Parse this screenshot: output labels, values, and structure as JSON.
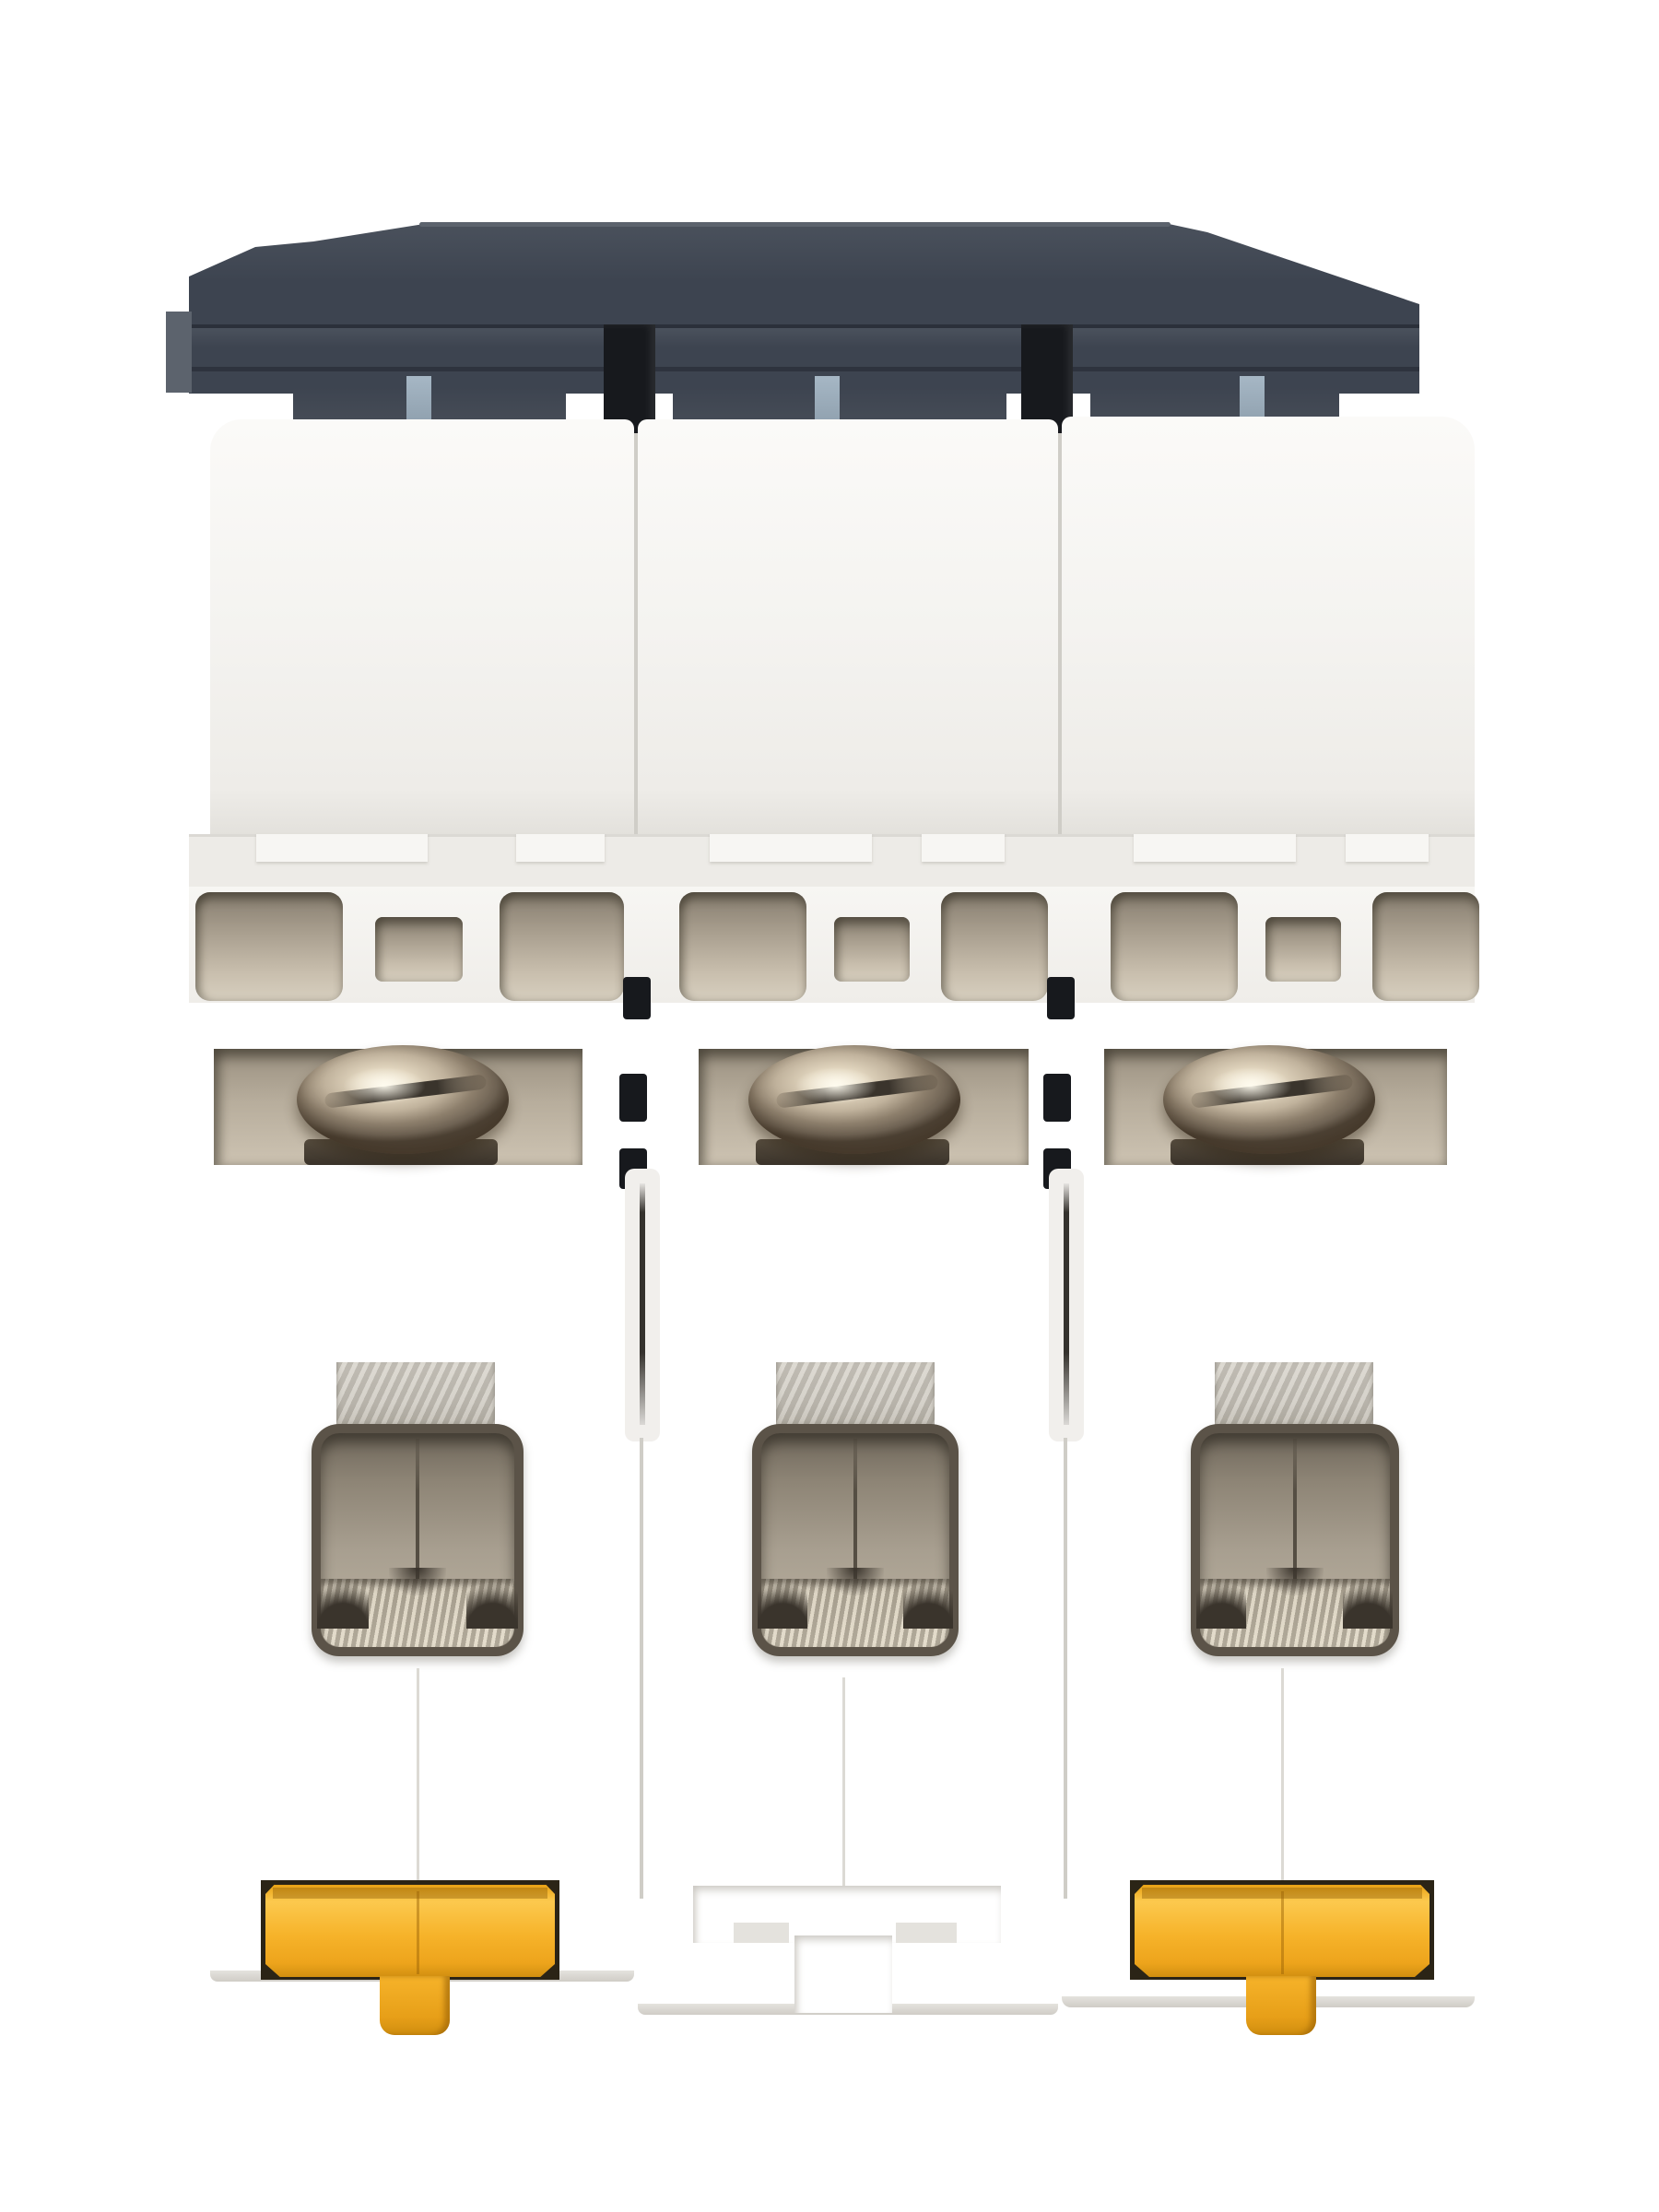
{
  "scene": {
    "kind": "product-photo",
    "subject": "three-pole miniature circuit breaker, rear/bottom view",
    "background": "plain white studio backdrop",
    "visible_text": "",
    "module_count": 3,
    "modules": [
      {
        "id": "pole-1",
        "terminal_screw": true,
        "din_clip": "yellow clip present"
      },
      {
        "id": "pole-2",
        "terminal_screw": true,
        "din_clip": "empty T-shaped slot"
      },
      {
        "id": "pole-3",
        "terminal_screw": true,
        "din_clip": "yellow clip present"
      }
    ],
    "parts": [
      "dark-gray-housing-top",
      "inter-module-black-tab",
      "blue-gray-latch-tab",
      "white-module-body",
      "ventilation-opening",
      "terminal-screw-head",
      "terminal-cage-window",
      "metal-clamp-tab",
      "din-rail-clip",
      "din-clip-release-tab"
    ]
  },
  "colors": {
    "bg": "#ffffff",
    "grayMain": "#3d4450",
    "grayLight": "#4b525d",
    "grayRim": "#5c636d",
    "grayDark": "#2b303a",
    "grayCastle": "#474d57",
    "blackTab": "#17191d",
    "blueTab": "#a6b7c5",
    "white": "#f4f3f0",
    "ledge": "#edebe7",
    "ventDark": "#857c6e",
    "ventLight": "#c9bfae",
    "recess": "#b7ad9c",
    "screwMid": "#c0b29c",
    "screwDark": "#6f6354",
    "slotDark": "#3a342c",
    "steel": "#ccc8c0",
    "frame": "#5b5348",
    "cavity": "#a89f90",
    "divider": "#554e43",
    "clip": "#f6b32a",
    "clipHi": "#fcc94e",
    "clipBack": "#2b2416"
  }
}
